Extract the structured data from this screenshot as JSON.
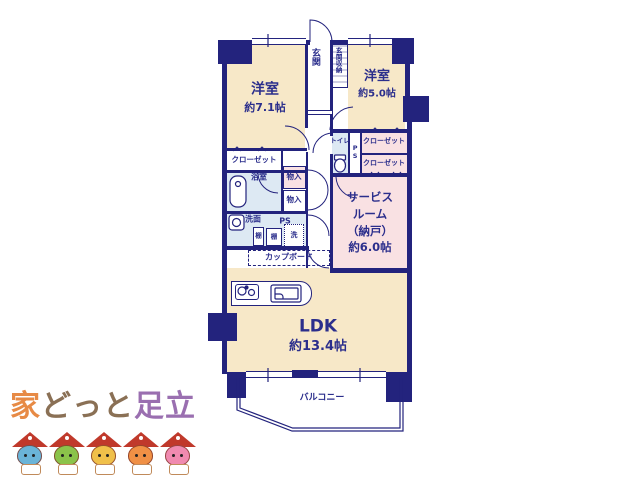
{
  "plan": {
    "room_yoshitsu_71": {
      "name": "洋室",
      "area": "約7.1帖"
    },
    "room_yoshitsu_50": {
      "name": "洋室",
      "area": "約5.0帖"
    },
    "ldk": {
      "name": "LDK",
      "area": "約13.4帖"
    },
    "service_room": {
      "line1": "サービス",
      "line2": "ルーム",
      "line3": "（納戸）",
      "line4": "約6.0帖"
    },
    "genkan": "玄関",
    "genkan_shuno": "玄関収納",
    "toilet": "トイレ",
    "ps_toilet": "PS",
    "ps_senmen": "PS",
    "closet_right_top": "クローゼット",
    "closet_right_bottom": "クローゼット",
    "closet_left": "クローゼット",
    "bathroom": "浴室",
    "monoire_top": "物入",
    "monoire_bottom": "物入",
    "senmen": "洗面",
    "tana_1": "棚",
    "tana_2": "棚",
    "laundry": "洗",
    "cupboard": "カップボード",
    "balcony": "バルコニー"
  },
  "logo": {
    "part_ie": "家",
    "part_dotto": "どっと",
    "part_adachi": "足立",
    "mascot_colors": [
      "#6ab4d8",
      "#8bc34a",
      "#f0c04a",
      "#f09045",
      "#f08ab0"
    ]
  },
  "colors": {
    "wall_navy": "#23237d",
    "text_navy": "#2b2e8c",
    "room_peach": "#f7e8c8",
    "room_pink": "#f9e1e3",
    "room_blue": "#dde9f3",
    "logo_ie_orange": "#e78a45",
    "logo_dotto_brown": "#8a7055",
    "logo_adachi_purple": "#9a6fb0",
    "mascot_roof_red": "#c0392b"
  }
}
